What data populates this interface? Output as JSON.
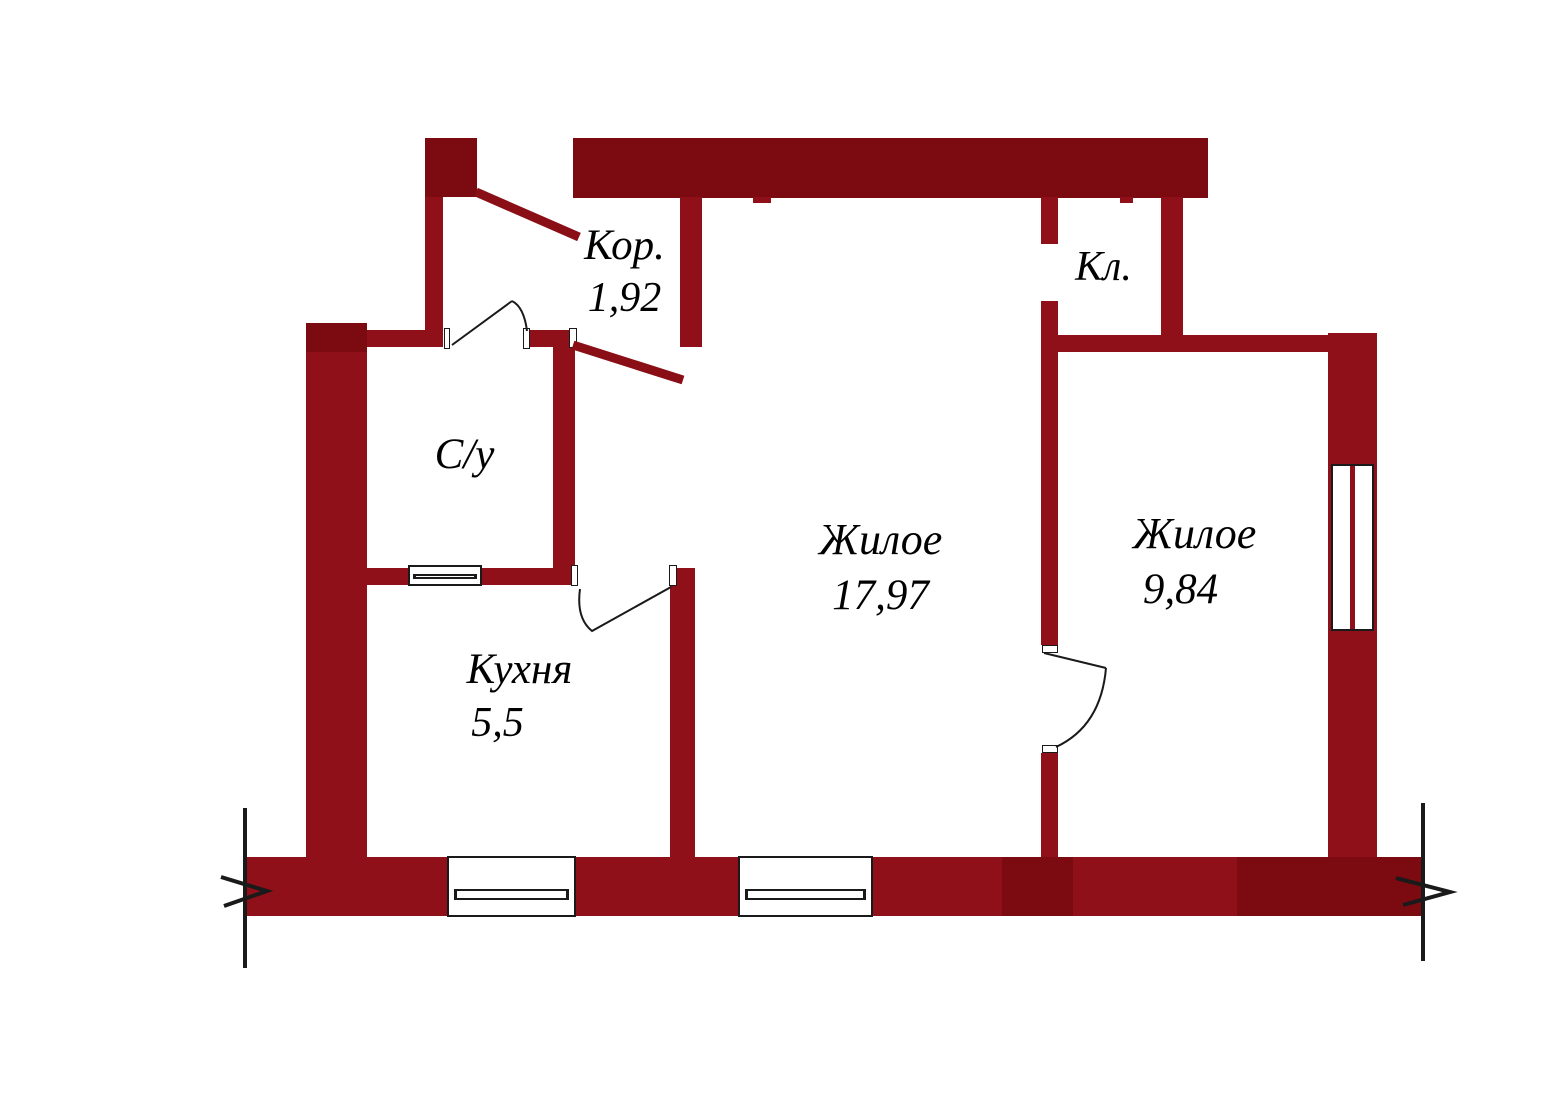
{
  "rooms": {
    "corridor": {
      "label": "Кор.",
      "area": "1,92"
    },
    "bathroom": {
      "label": "С/у"
    },
    "kitchen": {
      "label": "Кухня",
      "area": "5,5"
    },
    "living_main": {
      "label": "Жилое",
      "area": "17,97"
    },
    "closet": {
      "label": "Кл."
    },
    "living_second": {
      "label": "Жилое",
      "area": "9,84"
    }
  },
  "colors": {
    "wall": "#90101a",
    "wall_dark": "#7c0a11",
    "door_leaf_red": "#8a0e16",
    "line": "#1a1a1a",
    "background": "#ffffff"
  }
}
